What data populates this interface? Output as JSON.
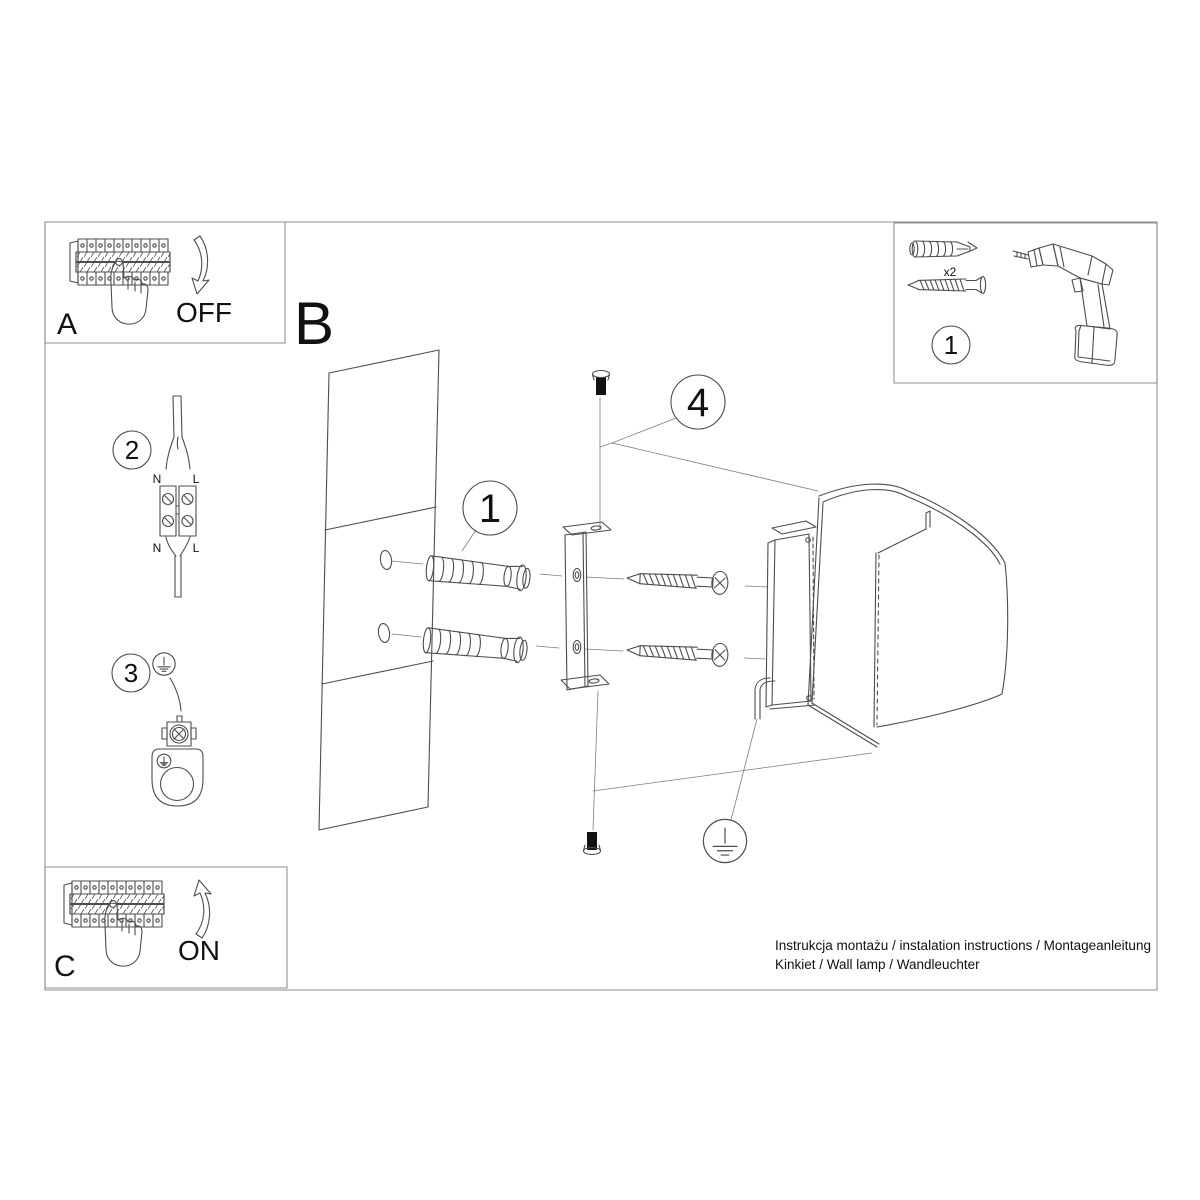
{
  "colors": {
    "background": "#ffffff",
    "line": "#4d4d4d",
    "frame": "#8f8f8f",
    "text": "#111111"
  },
  "panels": {
    "a": {
      "label": "A",
      "action": "OFF"
    },
    "b": {
      "label": "B"
    },
    "c": {
      "label": "C",
      "action": "ON"
    },
    "tools": {
      "step": "1",
      "anchor_qty": "x2"
    }
  },
  "callouts": {
    "wiring": "2",
    "ground": "3",
    "anchor": "1",
    "screws": "4"
  },
  "wiring": {
    "n_top": "N",
    "l_top": "L",
    "n_bot": "N",
    "l_bot": "L"
  },
  "footer": {
    "line1": "Instrukcja montażu / instalation instructions / Montageanleitung",
    "line2": "Kinkiet / Wall lamp / Wandleuchter"
  }
}
